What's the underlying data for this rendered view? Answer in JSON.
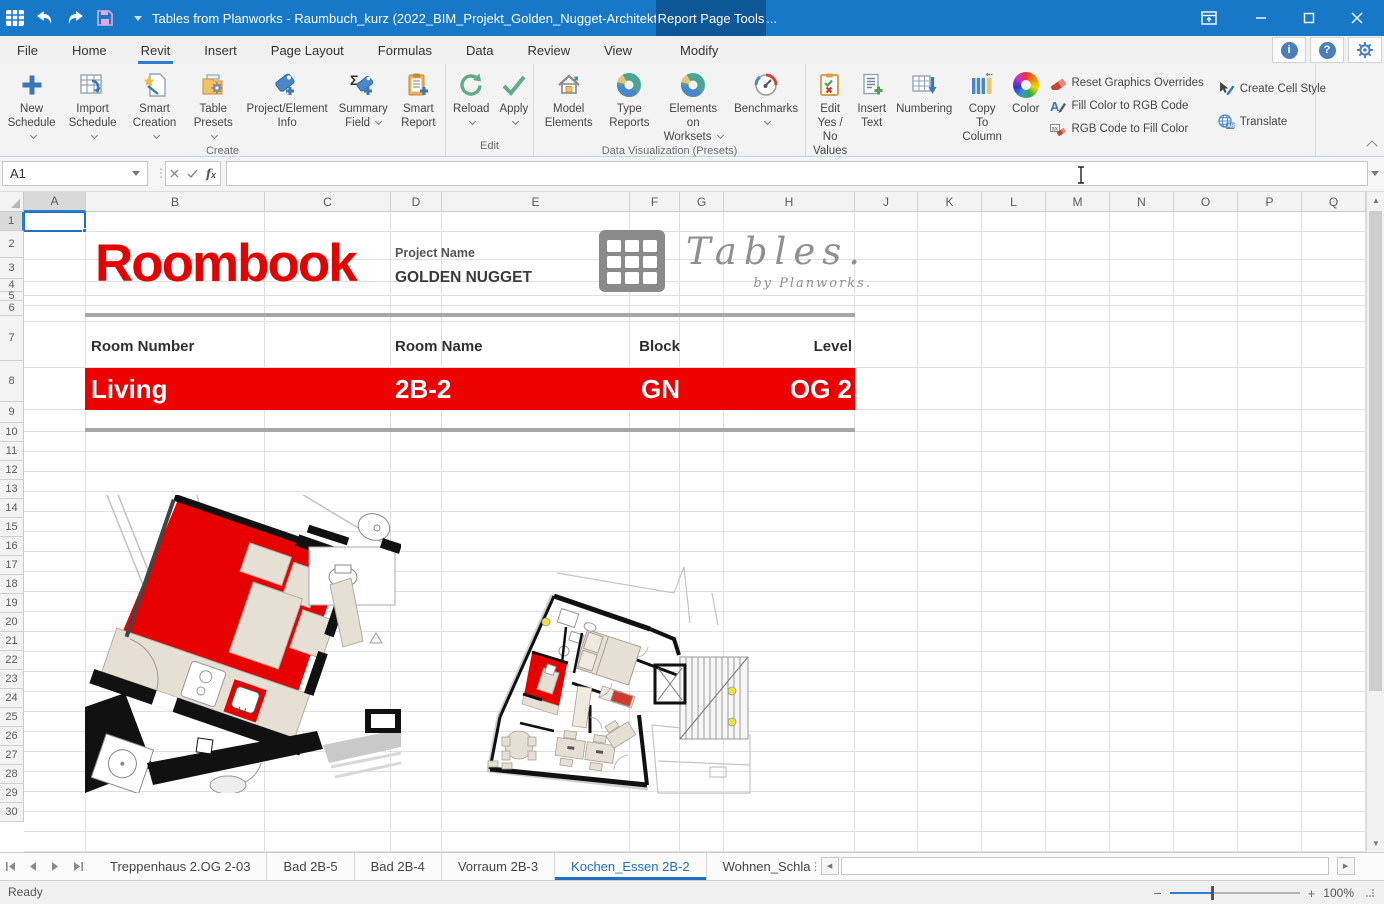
{
  "window": {
    "title": "Tables from Planworks - Raumbuch_kurz  (2022_BIM_Projekt_Golden_Nugget-Architektur_und_Ingenieurb...",
    "context_tab_label": "Report Page Tools"
  },
  "menu_tabs": {
    "active": "Revit",
    "items": [
      {
        "label": "File"
      },
      {
        "label": "Home"
      },
      {
        "label": "Revit"
      },
      {
        "label": "Insert"
      },
      {
        "label": "Page Layout"
      },
      {
        "label": "Formulas"
      },
      {
        "label": "Data"
      },
      {
        "label": "Review"
      },
      {
        "label": "View"
      },
      {
        "label": "Modify"
      }
    ]
  },
  "ribbon": {
    "groups": [
      {
        "label": "Create",
        "buttons": [
          {
            "label": "New Schedule",
            "dropdown": true
          },
          {
            "label": "Import Schedule",
            "dropdown": true
          },
          {
            "label": "Smart Creation",
            "dropdown": true
          },
          {
            "label": "Table Presets",
            "dropdown": true
          },
          {
            "label": "Project/Element Info",
            "dropdown": false
          },
          {
            "label": "Summary Field",
            "dropdown": true
          },
          {
            "label": "Smart Report",
            "dropdown": false
          }
        ]
      },
      {
        "label": "Edit",
        "buttons": [
          {
            "label": "Reload",
            "dropdown": true
          },
          {
            "label": "Apply",
            "dropdown": true
          }
        ]
      },
      {
        "label": "Data Visualization (Presets)",
        "buttons": [
          {
            "label": "Model Elements",
            "dropdown": false
          },
          {
            "label": "Type Reports",
            "dropdown": false
          },
          {
            "label": "Elements on Worksets",
            "dropdown": true
          },
          {
            "label": "Benchmarks",
            "dropdown": true
          }
        ]
      },
      {
        "label": "Miscellaneous",
        "buttons": [
          {
            "label": "Edit Yes / No Values",
            "dropdown": false
          },
          {
            "label": "Insert Text",
            "dropdown": false
          },
          {
            "label": "Numbering",
            "dropdown": false
          },
          {
            "label": "Copy To Column",
            "dropdown": false
          },
          {
            "label": "Color",
            "dropdown": false
          }
        ],
        "small_buttons": [
          {
            "label": "Reset Graphics Overrides"
          },
          {
            "label": "Fill Color to RGB Code"
          },
          {
            "label": "RGB Code to Fill Color"
          },
          {
            "label": "Create Cell Style"
          },
          {
            "label": "Translate"
          }
        ]
      }
    ]
  },
  "formula_bar": {
    "name_box": "A1",
    "formula_value": ""
  },
  "grid": {
    "selected_cell": "A1",
    "columns": [
      "A",
      "B",
      "C",
      "D",
      "E",
      "F",
      "G",
      "H",
      "J",
      "K",
      "L",
      "M",
      "N",
      "O",
      "P",
      "Q"
    ],
    "rows": [
      "1",
      "2",
      "3",
      "4",
      "5",
      "6",
      "7",
      "8",
      "9",
      "10",
      "11",
      "12",
      "13",
      "14",
      "15",
      "16",
      "17",
      "18",
      "19",
      "20",
      "21",
      "22",
      "23",
      "24",
      "25",
      "26",
      "27",
      "28",
      "29",
      "30"
    ]
  },
  "document": {
    "report_title": "Roombook",
    "project_name_label": "Project Name",
    "project_name_value": "GOLDEN NUGGET",
    "brand": {
      "name": "Tables.",
      "byline": "by Planworks."
    },
    "accent_red": "#e60000",
    "room_table": {
      "headers": [
        "Room Number",
        "Room Name",
        "Block",
        "Level"
      ],
      "values": [
        "Living",
        "2B-2",
        "GN",
        "OG 2"
      ]
    }
  },
  "sheet_tabs": {
    "active": "Kochen_Essen 2B-2",
    "tabs": [
      {
        "label": "Treppenhaus 2.OG 2-03"
      },
      {
        "label": "Bad 2B-5"
      },
      {
        "label": "Bad 2B-4"
      },
      {
        "label": "Vorraum 2B-3"
      },
      {
        "label": "Kochen_Essen 2B-2"
      },
      {
        "label": "Wohnen_Schla"
      }
    ]
  },
  "status_bar": {
    "status": "Ready",
    "zoom_level": "100%"
  }
}
